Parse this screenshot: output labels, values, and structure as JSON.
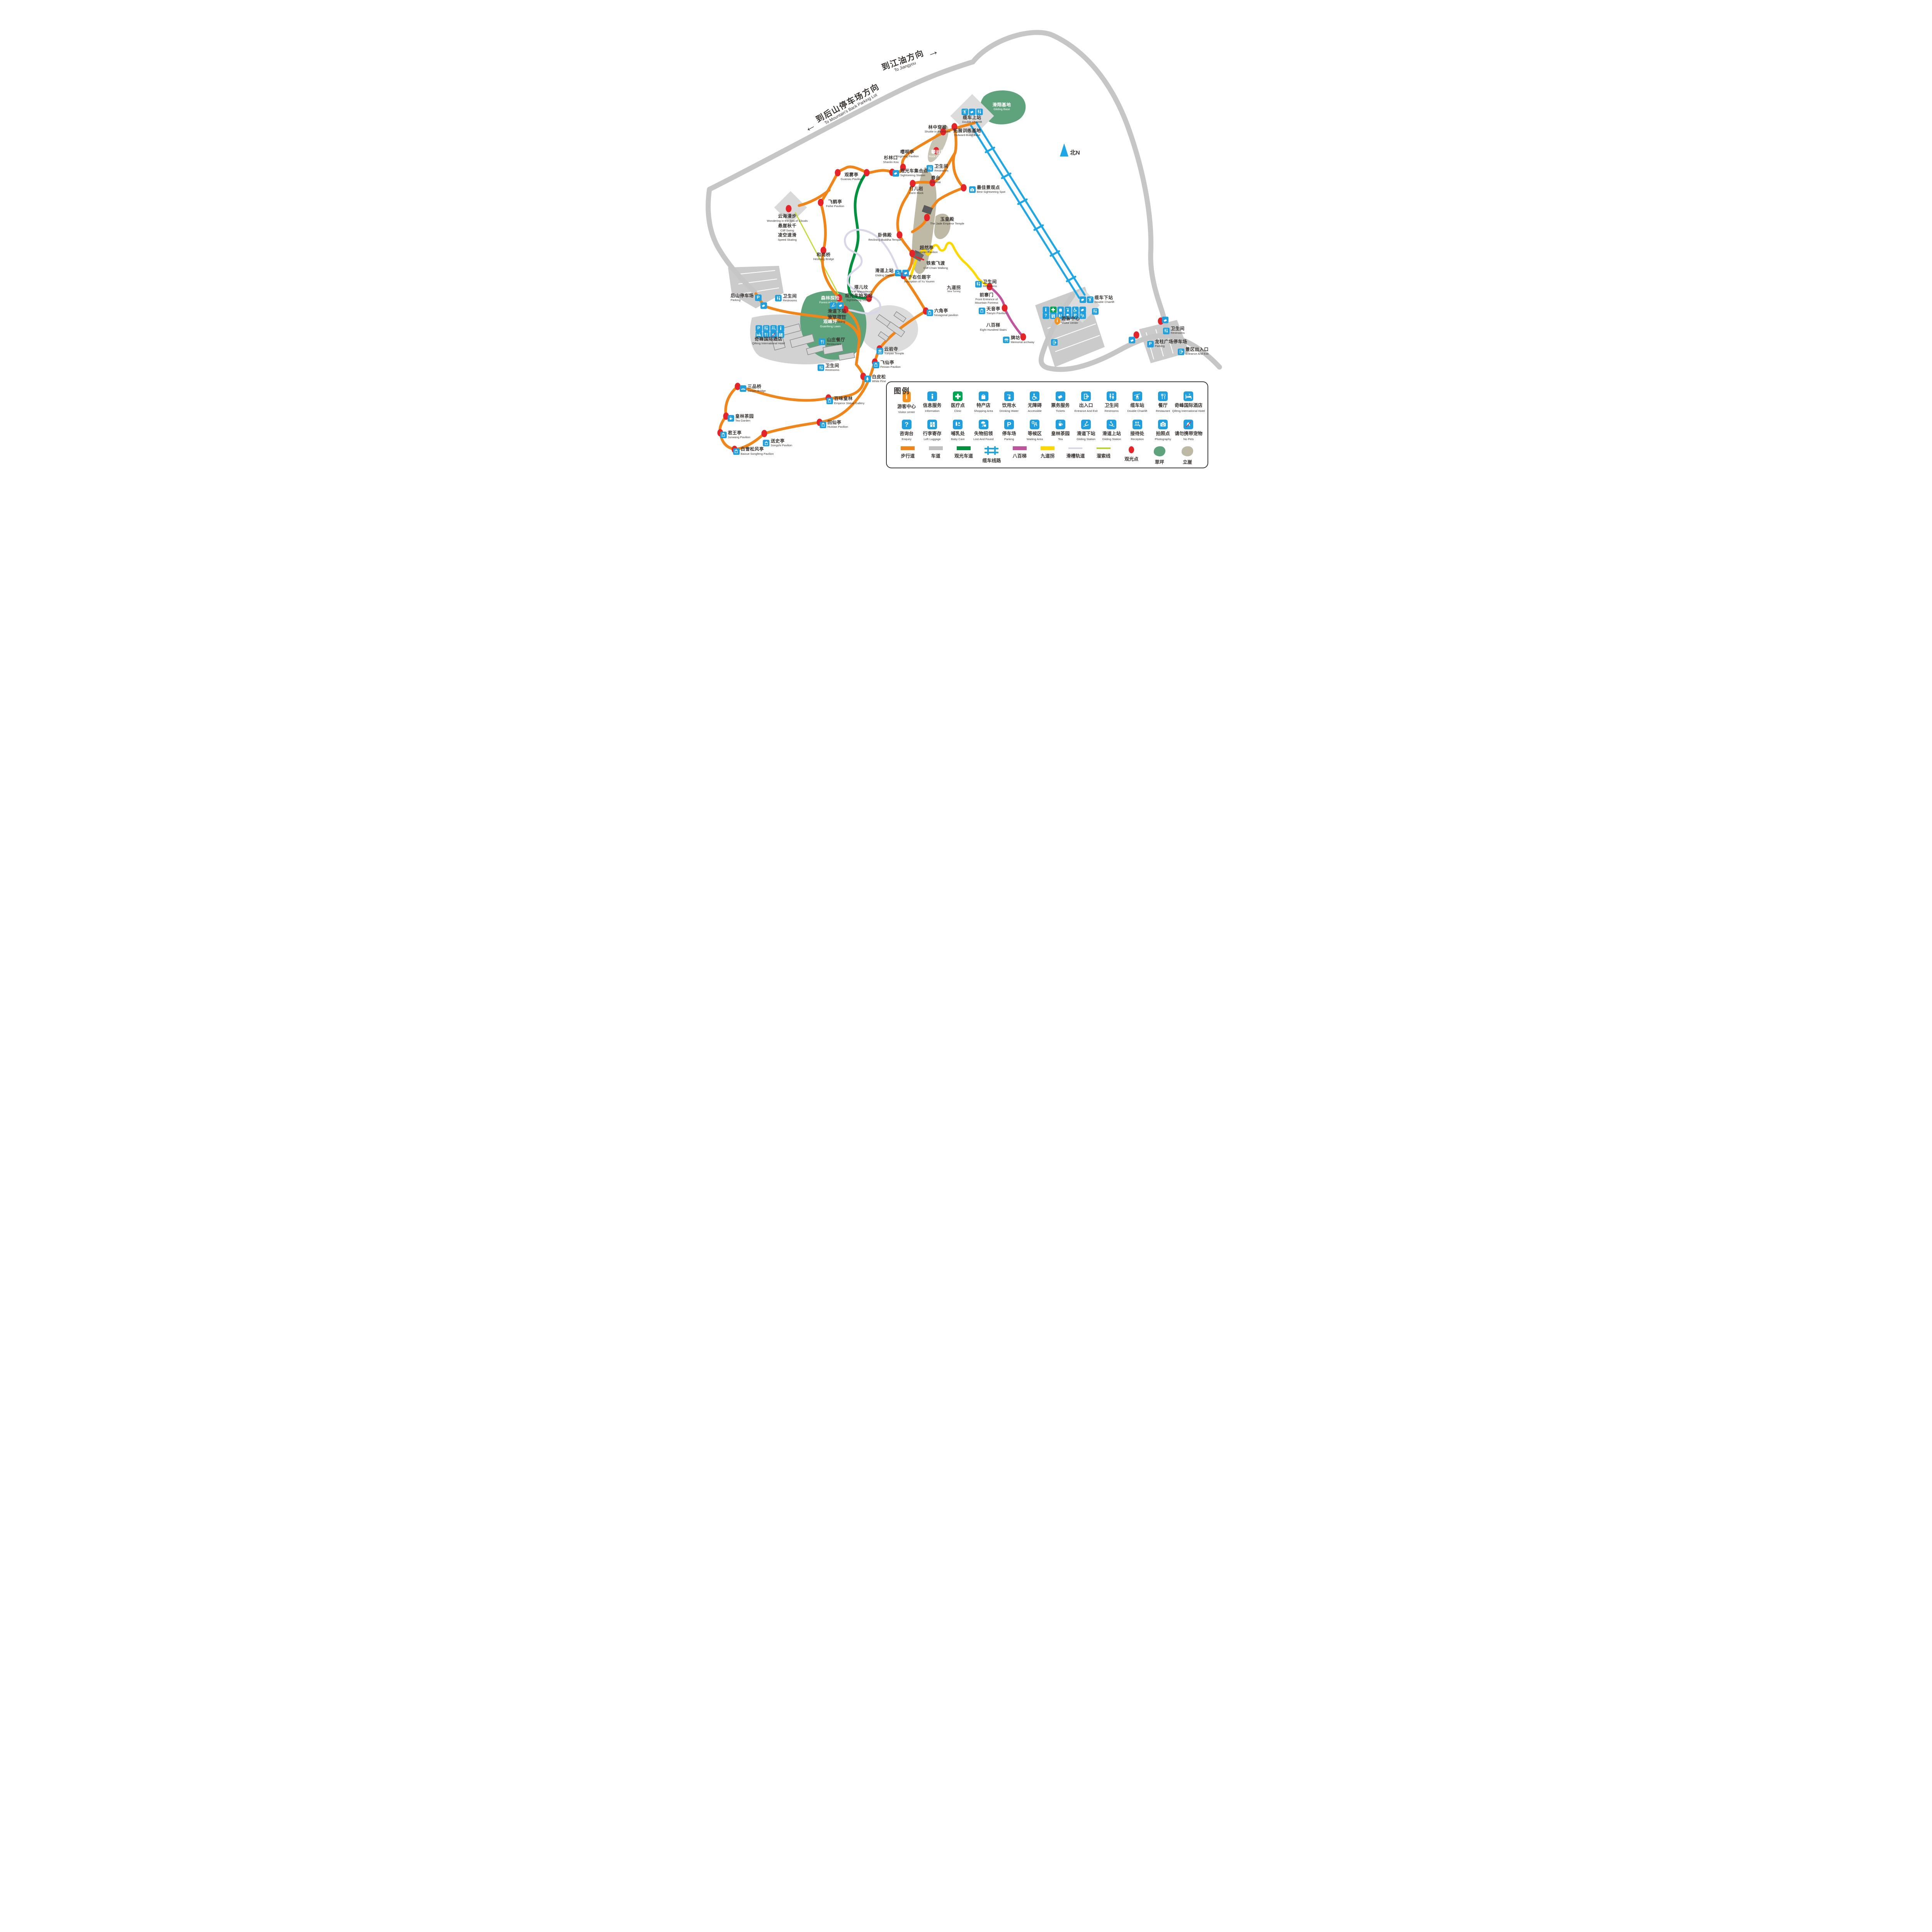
{
  "colors": {
    "walkway": "#F08519",
    "road": "#C6C6C6",
    "sightseeing_road": "#00913F",
    "cableway": "#1EA7E4",
    "stairs": "#C0549F",
    "nine_turning": "#FFD800",
    "chute": "#D9D6EA",
    "zipline": "#C6D93F",
    "spot": "#E5242A",
    "lawn": "#5FA37D",
    "cliff": "#BDB9A5",
    "service_blue": "#1F9FDE",
    "clinic_green": "#00A651",
    "visitor_orange": "#F6921E"
  },
  "north": {
    "label": "北N"
  },
  "arrows": {
    "jiangyou": {
      "cn": "到江油方向",
      "en": "To Jiangyou",
      "glyph": "→"
    },
    "backparking": {
      "cn": "到后山停车场方向",
      "en": "To Mountain's Back Parking Lot",
      "glyph": "←"
    }
  },
  "legend": {
    "title": "图例",
    "services1": [
      {
        "name": "legend-visitor-center",
        "icon": "visitor",
        "cn": "游客中心",
        "en": "Visitor center"
      },
      {
        "name": "legend-information",
        "icon": "info",
        "cn": "信息服务",
        "en": "Information"
      },
      {
        "name": "legend-clinic",
        "icon": "clinic",
        "cn": "医疗点",
        "en": "Clinic"
      },
      {
        "name": "legend-shopping-area",
        "icon": "shopping",
        "cn": "特产店",
        "en": "Shopping Area"
      },
      {
        "name": "legend-drinking-water",
        "icon": "water",
        "cn": "饮用水",
        "en": "Drinking Water"
      },
      {
        "name": "legend-accessible",
        "icon": "accessible",
        "cn": "无障碍",
        "en": "Accessible"
      },
      {
        "name": "legend-tickets",
        "icon": "ticket",
        "cn": "票务服务",
        "en": "Tickets"
      },
      {
        "name": "legend-entrance-exit",
        "icon": "entrance",
        "cn": "出入口",
        "en": "Entrance And Exit"
      },
      {
        "name": "legend-restrooms",
        "icon": "wc",
        "cn": "卫生间",
        "en": "Restrooms"
      },
      {
        "name": "legend-double-chairlift",
        "icon": "chairlift",
        "cn": "缆车站",
        "en": "Double Chairlift"
      },
      {
        "name": "legend-restaurant",
        "icon": "restaurant",
        "cn": "餐厅",
        "en": "Restaurant"
      },
      {
        "name": "legend-qifeng-hotel",
        "icon": "hotel",
        "cn": "奇峰国际酒店",
        "en": "Qifeng International Hotel"
      }
    ],
    "services2": [
      {
        "name": "legend-enquiry",
        "icon": "enquiry",
        "cn": "咨询台",
        "en": "Enquiry"
      },
      {
        "name": "legend-left-luggage",
        "icon": "luggage",
        "cn": "行李寄存",
        "en": "Left Luggage"
      },
      {
        "name": "legend-baby-care",
        "icon": "babycare",
        "cn": "哺乳处",
        "en": "Baby Care"
      },
      {
        "name": "legend-lost-and-found",
        "icon": "lostfound",
        "cn": "失物招领",
        "en": "Lost And Found"
      },
      {
        "name": "legend-parking",
        "icon": "parking",
        "cn": "停车场",
        "en": "Parking"
      },
      {
        "name": "legend-waiting-area",
        "icon": "waiting",
        "cn": "等候区",
        "en": "Waiting Area"
      },
      {
        "name": "legend-tea",
        "icon": "tea",
        "cn": "皇林茶园",
        "en": "Tea"
      },
      {
        "name": "legend-gliding-lower",
        "icon": "gliding",
        "cn": "滑道下站",
        "en": "Gliding Station"
      },
      {
        "name": "legend-gliding-upper",
        "icon": "glidingup",
        "cn": "滑道上站",
        "en": "Gliding Station"
      },
      {
        "name": "legend-reception",
        "icon": "reception",
        "cn": "接待处",
        "en": "Reception"
      },
      {
        "name": "legend-photography",
        "icon": "photography",
        "cn": "拍照点",
        "en": "Photography"
      },
      {
        "name": "legend-no-pets",
        "icon": "nopets",
        "cn": "请勿携带宠物",
        "en": "No Pets"
      }
    ],
    "routes": [
      {
        "name": "legend-walkway",
        "kind": "line",
        "color": "#F08519",
        "cn": "步行道"
      },
      {
        "name": "legend-road",
        "kind": "line",
        "color": "#C0C0C0",
        "cn": "车道"
      },
      {
        "name": "legend-sightseeing-road",
        "kind": "line",
        "color": "#00913F",
        "cn": "观光车道"
      },
      {
        "name": "legend-cableway",
        "kind": "rail",
        "color": "#1EA7E4",
        "cn": "缆车线路"
      },
      {
        "name": "legend-eight-hundred-stairs",
        "kind": "line",
        "color": "#C0549F",
        "cn": "八百梯"
      },
      {
        "name": "legend-nine-turning",
        "kind": "line",
        "color": "#FFD800",
        "cn": "九道拐"
      },
      {
        "name": "legend-chute-track",
        "kind": "thin",
        "color": "#D9D6EA",
        "cn": "滑槽轨道"
      },
      {
        "name": "legend-zipline",
        "kind": "thin",
        "color": "#B5D334",
        "cn": "溜索线"
      },
      {
        "name": "legend-sightseeing-spot",
        "kind": "dot",
        "color": "#E5242A",
        "cn": "观光点"
      },
      {
        "name": "legend-lawn",
        "kind": "blob",
        "color": "#5FA37D",
        "cn": "草坪"
      },
      {
        "name": "legend-cliff",
        "kind": "blob",
        "color": "#BDB9A5",
        "cn": "立崖"
      }
    ]
  },
  "pois": [
    {
      "name": "shuttle-in-the-forest",
      "cn": "林中穿梭",
      "en": "Shuttle in the Forest",
      "x": 45.3,
      "y": 26.6,
      "cls": "col"
    },
    {
      "name": "outward-bund-base",
      "cn": "拓展训练基地",
      "en": "Outward-Bund Base",
      "x": 50.2,
      "y": 27.3,
      "cls": "col"
    },
    {
      "name": "gliding-base",
      "cn": "滑翔基地",
      "en": "Gliding Base",
      "x": 55.9,
      "y": 22.0,
      "cls": "col w"
    },
    {
      "name": "double-chairlift-upper",
      "cn": "缆车上站",
      "en": "Double Chairlift",
      "x": 51.0,
      "y": 23.9,
      "cls": "col",
      "icons": [
        "chairlift",
        "ticket",
        "wc"
      ]
    },
    {
      "name": "rock-climbing",
      "cn": "攀岩场",
      "en": "Rock Climbing",
      "x": 45.4,
      "y": 31.7,
      "cls": "col w"
    },
    {
      "name": "yingming-pavilion",
      "cn": "嘤明亭",
      "en": "Yingming Pavilion",
      "x": 40.3,
      "y": 31.7,
      "cls": "col"
    },
    {
      "name": "shanlin-kou",
      "cn": "杉林口",
      "en": "Shanlin Kou",
      "x": 37.6,
      "y": 32.9,
      "cls": "col"
    },
    {
      "name": "restrooms-chuntai",
      "cn": "卫生间",
      "en": "Restrooms",
      "x": 45.3,
      "y": 34.6,
      "icons": [
        "wc"
      ]
    },
    {
      "name": "sightseeing-station-meeting",
      "cn": "观光车集合点",
      "en": "Sightseeing Station",
      "x": 40.8,
      "y": 35.6,
      "icons": [
        "ticket"
      ]
    },
    {
      "name": "guanwu-pavilion",
      "cn": "观雾亭",
      "en": "Guanwu Pavilion",
      "x": 31.1,
      "y": 36.4,
      "cls": "col"
    },
    {
      "name": "feihe-pavilion",
      "cn": "飞鹤亭",
      "en": "Feihe Pavilion",
      "x": 28.4,
      "y": 41.9,
      "cls": "col"
    },
    {
      "name": "sea-of-clouds-walk",
      "cn": "云海漫步",
      "en": "Wondering in the Sea of Clouds",
      "x": 20.5,
      "y": 44.9,
      "cls": "col"
    },
    {
      "name": "cliff-swing",
      "cn": "悬崖秋千",
      "en": "Cliff Swing",
      "x": 20.5,
      "y": 46.9,
      "cls": "col"
    },
    {
      "name": "speed-skating",
      "cn": "凌空速滑",
      "en": "Speed Skating",
      "x": 20.5,
      "y": 48.8,
      "cls": "col"
    },
    {
      "name": "chuntai",
      "cn": "春台",
      "en": "Chuntai",
      "x": 45.0,
      "y": 37.0,
      "cls": "col"
    },
    {
      "name": "daer-rock",
      "cn": "打儿岩",
      "en": "Da'er Rock",
      "x": 41.8,
      "y": 39.2,
      "cls": "col"
    },
    {
      "name": "best-sightseeing-spot",
      "cn": "最佳景观点",
      "en": "Best Sightseeing Spot",
      "x": 53.5,
      "y": 39.0,
      "icons": [
        "photography"
      ]
    },
    {
      "name": "jade-emperor-temple",
      "cn": "玉皇殿",
      "en": "The Jade Emperor Temple",
      "x": 46.9,
      "y": 45.5,
      "cls": "col"
    },
    {
      "name": "reclining-buddha-temple",
      "cn": "卧佛殿",
      "en": "Reclining Buddha Temple",
      "x": 36.6,
      "y": 48.8,
      "cls": "col"
    },
    {
      "name": "chaoran-pavilion",
      "cn": "超然亭",
      "en": "Chaoran Pavilion",
      "x": 43.5,
      "y": 51.4,
      "cls": "col"
    },
    {
      "name": "cliff-chain-walking",
      "cn": "铁索飞渡",
      "en": "Cliff Chain Walking",
      "x": 45.0,
      "y": 54.6,
      "cls": "col"
    },
    {
      "name": "gliding-station-upper",
      "cn": "滑道上站",
      "en": "Gliding Station",
      "x": 37.8,
      "y": 56.1,
      "cls": "ia",
      "icons": [
        "glidingup",
        "ticket"
      ]
    },
    {
      "name": "inscription-of-yu-youren",
      "cn": "于右任题字",
      "en": "Inscription of Yu Youren",
      "x": 42.3,
      "y": 57.4,
      "cls": "col"
    },
    {
      "name": "taer-mausoleum",
      "cn": "塔儿坟",
      "en": "Ta'er Mausoleum",
      "x": 32.7,
      "y": 59.5,
      "cls": "col"
    },
    {
      "name": "sightseeing-station-start",
      "cn": "观光车始发站",
      "en": "Sightseeing Station",
      "x": 32.3,
      "y": 61.2,
      "cls": "col"
    },
    {
      "name": "forest-adventure",
      "cn": "森林探险",
      "en": "Forest Adventure",
      "x": 27.6,
      "y": 61.7,
      "cls": "col w"
    },
    {
      "name": "heshang-bridge",
      "cn": "和尚桥",
      "en": "Heshang Bridge",
      "x": 26.5,
      "y": 52.8,
      "cls": "col"
    },
    {
      "name": "gliding-station-lower",
      "cn": "滑道下站",
      "en": "Gliding Station",
      "x": 28.7,
      "y": 63.7,
      "cls": "col",
      "icons": [
        "gliding",
        "ticket"
      ]
    },
    {
      "name": "grass-skiing",
      "cn": "滑草项目",
      "en": "Grass Skiing",
      "x": 28.7,
      "y": 65.7,
      "cls": "col"
    },
    {
      "name": "guanfeng-lawn",
      "cn": "观峰坪",
      "en": "Guanfeng Lawn",
      "x": 27.6,
      "y": 66.6,
      "cls": "col w"
    },
    {
      "name": "back-mountain-parking",
      "cn": "后山停车场",
      "en": "Parking",
      "x": 13.7,
      "y": 61.2,
      "cls": "ia",
      "icons": [
        "parking"
      ]
    },
    {
      "name": "restrooms-back-parking",
      "cn": "卫生间",
      "en": "Restrooms",
      "x": 20.3,
      "y": 61.3,
      "icons": [
        "wc"
      ]
    },
    {
      "name": "hotel-services-row-1",
      "x": 17.7,
      "y": 67.5,
      "icons": [
        "parking",
        "wc",
        "reception",
        "info"
      ]
    },
    {
      "name": "hotel-services-row-2",
      "x": 17.7,
      "y": 68.8,
      "icons": [
        "hotel",
        "restaurant",
        "nopets",
        "luggage"
      ]
    },
    {
      "name": "qifeng-international-hotel",
      "cn": "奇峰国际酒店",
      "en": "Qifeng International Hotel",
      "x": 17.4,
      "y": 70.1,
      "cls": "col"
    },
    {
      "name": "shanzhuang-restaurant",
      "cn": "山庄餐厅",
      "en": "Restaurant",
      "x": 27.9,
      "y": 70.3,
      "icons": [
        "restaurant"
      ]
    },
    {
      "name": "restrooms-restaurant",
      "cn": "卫生间",
      "en": "Restrooms",
      "x": 27.3,
      "y": 75.6,
      "icons": [
        "wc"
      ]
    },
    {
      "name": "yunyan-temple",
      "cn": "云岩寺",
      "en": "Yunyan Temple",
      "x": 37.5,
      "y": 72.2,
      "icons": [
        "temple"
      ]
    },
    {
      "name": "feixian-pavilion",
      "cn": "飞仙亭",
      "en": "Feixian Pavilion",
      "x": 36.9,
      "y": 75.0,
      "icons": [
        "pavilion"
      ]
    },
    {
      "name": "white-pine",
      "cn": "白皮松",
      "en": "White Pine",
      "x": 35.0,
      "y": 77.9,
      "icons": [
        "pine"
      ]
    },
    {
      "name": "emperor-statue-gallery",
      "cn": "百味皇林",
      "en": "Emperor Statue Gallery",
      "x": 30.1,
      "y": 82.4,
      "icons": [
        "pavilion"
      ]
    },
    {
      "name": "sanpin-bridge",
      "cn": "三品桥",
      "en": "Sanpin Bridge",
      "x": 14.8,
      "y": 79.9,
      "icons": [
        "bridge"
      ]
    },
    {
      "name": "tea-garden",
      "cn": "皇林茶园",
      "en": "Tea Garden",
      "x": 12.8,
      "y": 86.0,
      "icons": [
        "tea"
      ]
    },
    {
      "name": "junwang-pavilion",
      "cn": "君王亭",
      "en": "Junwang Pavilion",
      "x": 11.9,
      "y": 89.4,
      "icons": [
        "pavilion"
      ]
    },
    {
      "name": "baixue-songfeng-pavilion",
      "cn": "白雪松风亭",
      "en": "Baixue Songfeng Pavilion",
      "x": 14.9,
      "y": 92.8,
      "icons": [
        "pavilion"
      ]
    },
    {
      "name": "songshi-pavilion",
      "cn": "送史亭",
      "en": "Songshi Pavilion",
      "x": 18.9,
      "y": 91.1,
      "icons": [
        "pavilion"
      ]
    },
    {
      "name": "huixian-pavilion",
      "cn": "回仙亭",
      "en": "Huixian Pavilion",
      "x": 28.2,
      "y": 87.3,
      "icons": [
        "pavilion"
      ]
    },
    {
      "name": "hexagonal-pavilion",
      "cn": "六角亭",
      "en": "hexagonal pavilion",
      "x": 46.1,
      "y": 64.3,
      "icons": [
        "pavilion"
      ]
    },
    {
      "name": "nine-turning",
      "cn": "九道拐",
      "en": "Nine Turning",
      "x": 48.0,
      "y": 59.5,
      "cls": "col sm"
    },
    {
      "name": "restrooms-nine-turning",
      "cn": "卫生间",
      "en": "Restrooms",
      "x": 53.3,
      "y": 58.4,
      "icons": [
        "wc"
      ]
    },
    {
      "name": "front-entrance-fortress",
      "cn": "前寨门",
      "en": "Front Entrance of",
      "en2": "Mountain Fortress",
      "x": 53.4,
      "y": 61.4,
      "cls": "col"
    },
    {
      "name": "tianyin-pavilion",
      "cn": "天音亭",
      "en": "Tianyin Pavilion",
      "x": 54.4,
      "y": 63.9,
      "icons": [
        "pavilion"
      ]
    },
    {
      "name": "eight-hundred-stairs",
      "cn": "八百梯",
      "en": "Eight Hundred Stairs",
      "x": 54.5,
      "y": 67.3,
      "cls": "col"
    },
    {
      "name": "memorial-archway",
      "cn": "牌坊",
      "en": "Memorial archway",
      "x": 58.7,
      "y": 69.9,
      "icons": [
        "archway"
      ]
    },
    {
      "name": "visitor-services-row-1",
      "x": 66.3,
      "y": 63.7,
      "icons": [
        "info",
        "clinic",
        "shopping",
        "water",
        "accessible",
        "ticket"
      ]
    },
    {
      "name": "visitor-services-row-2",
      "x": 66.3,
      "y": 64.9,
      "icons": [
        "enquiry",
        "luggage",
        "babycare",
        "lostfound",
        "parking",
        "waiting"
      ]
    },
    {
      "name": "visitor-center",
      "cn": "游客中心",
      "en": "Visitor center",
      "x": 66.7,
      "y": 65.9,
      "icons": [
        "visitor"
      ]
    },
    {
      "name": "restrooms-visitor-center",
      "x": 71.4,
      "y": 64.0,
      "icons": [
        "wc"
      ]
    },
    {
      "name": "entrance-exit-visitor",
      "x": 64.7,
      "y": 70.4,
      "icons": [
        "entrance"
      ]
    },
    {
      "name": "double-chairlift-lower",
      "cn": "缆车下站",
      "en": "Double Chairlift",
      "x": 71.6,
      "y": 61.6,
      "icons": [
        "ticket",
        "chairlift"
      ]
    },
    {
      "name": "longzhu-square-parking",
      "cn": "龙柱广场停车场",
      "en": "Parking",
      "x": 83.2,
      "y": 70.7,
      "icons": [
        "parking"
      ]
    },
    {
      "name": "restrooms-longzhu",
      "cn": "卫生间",
      "en": "Restrooms",
      "x": 84.3,
      "y": 68.0,
      "icons": [
        "wc"
      ]
    },
    {
      "name": "entrance-and-exit",
      "cn": "景区出入口",
      "en": "Entrance And Exit",
      "x": 87.5,
      "y": 72.3,
      "icons": [
        "entrance"
      ]
    },
    {
      "name": "ticket-back-parking",
      "x": 16.7,
      "y": 62.8,
      "icons": [
        "ticket"
      ]
    },
    {
      "name": "ticket-longzhu-west",
      "x": 77.5,
      "y": 69.9,
      "icons": [
        "ticket"
      ]
    },
    {
      "name": "ticket-longzhu-north",
      "x": 83.0,
      "y": 65.8,
      "icons": [
        "ticket"
      ]
    }
  ],
  "dots": [
    [
      754,
      328
    ],
    [
      725,
      341
    ],
    [
      707,
      390
    ],
    [
      621,
      433
    ],
    [
      593,
      446
    ],
    [
      527,
      447
    ],
    [
      452,
      447
    ],
    [
      408,
      524
    ],
    [
      325,
      540
    ],
    [
      415,
      648
    ],
    [
      646,
      475
    ],
    [
      697,
      473
    ],
    [
      778,
      486
    ],
    [
      683,
      563
    ],
    [
      612,
      608
    ],
    [
      645,
      656
    ],
    [
      622,
      713
    ],
    [
      456,
      771
    ],
    [
      533,
      772
    ],
    [
      472,
      801
    ],
    [
      518,
      974
    ],
    [
      548,
      937
    ],
    [
      560,
      903
    ],
    [
      428,
      1030
    ],
    [
      193,
      1000
    ],
    [
      163,
      1077
    ],
    [
      148,
      1120
    ],
    [
      185,
      1163
    ],
    [
      262,
      1122
    ],
    [
      405,
      1093
    ],
    [
      680,
      805
    ],
    [
      845,
      742
    ],
    [
      884,
      797
    ],
    [
      932,
      872
    ],
    [
      1225,
      867
    ],
    [
      1288,
      831
    ]
  ]
}
